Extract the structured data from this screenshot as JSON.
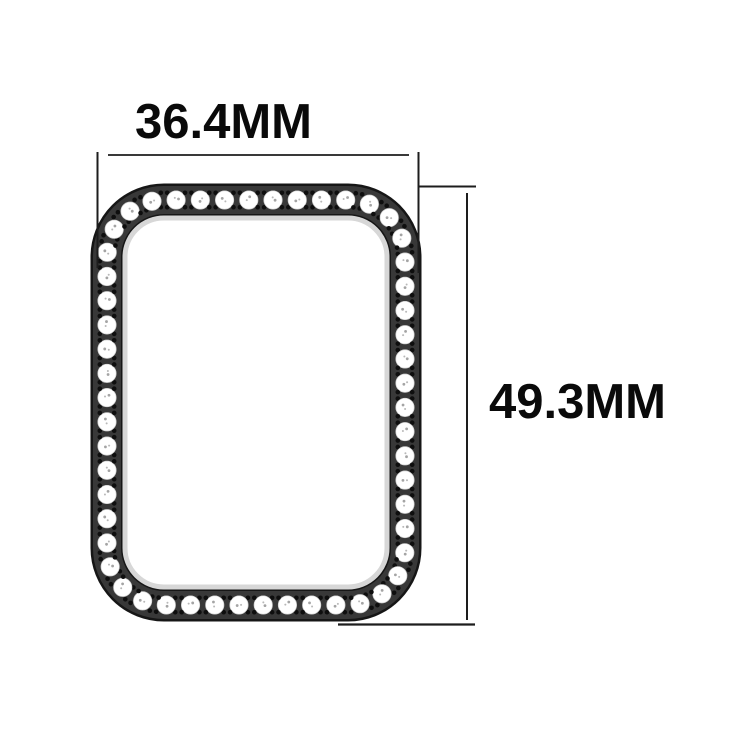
{
  "product": {
    "name": "watch-case-bumper-with-rhinestones",
    "stone_count": 54,
    "dots_per_gap": 4
  },
  "dimensions": {
    "width": {
      "value": "36.4",
      "unit": "MM",
      "label": "36.4MM"
    },
    "height": {
      "value": "49.3",
      "unit": "MM",
      "label": "49.3MM"
    }
  },
  "colors": {
    "background": "#ffffff",
    "frame_band": "#383838",
    "frame_outline": "#161616",
    "inner_highlight": "#d7d7d7",
    "stone_fill": "#ffffff",
    "stone_edge": "#cfcfcf",
    "stone_detail": "#9a9a9a",
    "stud_dot": "#0e0e0e",
    "dimension_line": "#1d1d1d",
    "label_text": "#0a0a0a"
  }
}
